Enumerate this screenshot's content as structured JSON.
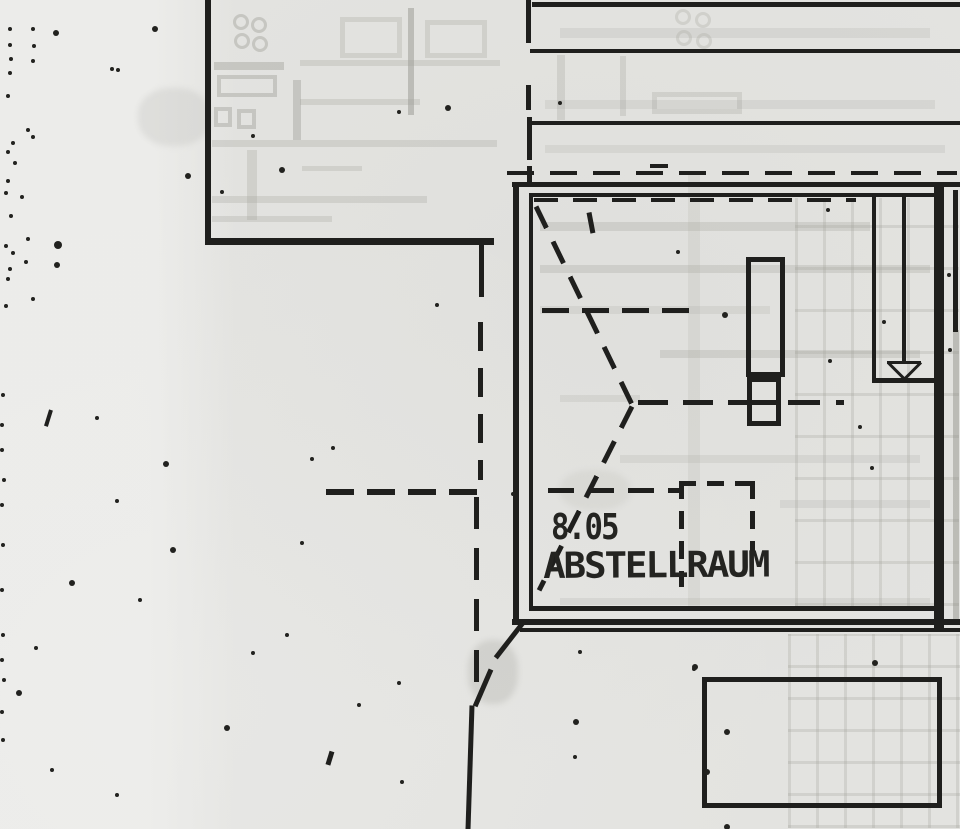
{
  "labels": {
    "room_number": "8.05",
    "room_name": "ABSTELLRAUM"
  },
  "colors": {
    "paper": "#e3e3e0",
    "ink": "#1f1f1d",
    "ghost": "rgba(155,155,148,0.40)",
    "ghost_light": "rgba(165,165,158,0.30)",
    "ghost_faint": "rgba(165,165,158,0.20)",
    "ghost_grid": "rgba(158,158,150,0.26)"
  },
  "elements": [
    {
      "k": "g",
      "n": "ghost-grid-right",
      "x": 795,
      "y": 198,
      "wd": 164,
      "ht": 408,
      "cw": 28,
      "ch": 42,
      "lw": 3,
      "c": "rgba(158,158,150,0.26)"
    },
    {
      "k": "g",
      "n": "ghost-grid-bottom",
      "x": 788,
      "y": 634,
      "wd": 172,
      "ht": 194,
      "cw": 28,
      "ch": 32,
      "lw": 3,
      "c": "rgba(158,158,150,0.26)"
    },
    {
      "k": "v",
      "n": "ghost-crease",
      "x": 688,
      "y": 172,
      "len": 436,
      "w": 12,
      "c": "rgba(170,170,163,0.18)"
    },
    {
      "k": "c",
      "n": "ghost-circle",
      "x": 241,
      "y": 22,
      "r": 8,
      "c": "rgba(155,155,148,0.40)"
    },
    {
      "k": "c",
      "n": "ghost-circle",
      "x": 259,
      "y": 25,
      "r": 8,
      "c": "rgba(155,155,148,0.40)"
    },
    {
      "k": "c",
      "n": "ghost-circle",
      "x": 242,
      "y": 41,
      "r": 8,
      "c": "rgba(155,155,148,0.40)"
    },
    {
      "k": "c",
      "n": "ghost-circle",
      "x": 260,
      "y": 44,
      "r": 8,
      "c": "rgba(155,155,148,0.40)"
    },
    {
      "k": "h",
      "n": "ghost-line",
      "x": 214,
      "y": 62,
      "len": 70,
      "w": 8,
      "c": "rgba(155,155,148,0.40)"
    },
    {
      "k": "r",
      "n": "ghost-rect",
      "x": 217,
      "y": 75,
      "wd": 60,
      "ht": 22,
      "w": 4,
      "c": "rgba(155,155,148,0.40)"
    },
    {
      "k": "r",
      "n": "ghost-rect",
      "x": 214,
      "y": 107,
      "wd": 18,
      "ht": 20,
      "w": 4,
      "c": "rgba(155,155,148,0.40)"
    },
    {
      "k": "r",
      "n": "ghost-rect",
      "x": 237,
      "y": 109,
      "wd": 19,
      "ht": 20,
      "w": 4,
      "c": "rgba(155,155,148,0.40)"
    },
    {
      "k": "v",
      "n": "ghost-line",
      "x": 293,
      "y": 80,
      "len": 60,
      "w": 8,
      "c": "rgba(155,155,148,0.40)"
    },
    {
      "k": "r",
      "n": "ghost-rect",
      "x": 340,
      "y": 17,
      "wd": 62,
      "ht": 41,
      "w": 5,
      "c": "rgba(165,165,158,0.30)"
    },
    {
      "k": "v",
      "n": "ghost-wall-line",
      "x": 408,
      "y": 8,
      "len": 107,
      "w": 6,
      "c": "rgba(150,150,143,0.50)"
    },
    {
      "k": "r",
      "n": "ghost-rect",
      "x": 425,
      "y": 20,
      "wd": 62,
      "ht": 38,
      "w": 5,
      "c": "rgba(165,165,158,0.30)"
    },
    {
      "k": "h",
      "n": "ghost-line",
      "x": 300,
      "y": 60,
      "len": 200,
      "w": 6,
      "c": "rgba(165,165,158,0.30)"
    },
    {
      "k": "h",
      "n": "ghost-line",
      "x": 300,
      "y": 99,
      "len": 120,
      "w": 6,
      "c": "rgba(165,165,158,0.30)"
    },
    {
      "k": "h",
      "n": "ghost-line",
      "x": 212,
      "y": 140,
      "len": 285,
      "w": 7,
      "c": "rgba(165,165,158,0.30)"
    },
    {
      "k": "h",
      "n": "ghost-line",
      "x": 212,
      "y": 196,
      "len": 215,
      "w": 7,
      "c": "rgba(165,165,158,0.30)"
    },
    {
      "k": "h",
      "n": "ghost-line",
      "x": 212,
      "y": 216,
      "len": 120,
      "w": 6,
      "c": "rgba(165,165,158,0.30)"
    },
    {
      "k": "v",
      "n": "ghost-line",
      "x": 247,
      "y": 150,
      "len": 70,
      "w": 10,
      "c": "rgba(165,165,158,0.30)"
    },
    {
      "k": "h",
      "n": "ghost-line",
      "x": 302,
      "y": 166,
      "len": 60,
      "w": 5,
      "c": "rgba(165,165,158,0.30)"
    },
    {
      "k": "c",
      "n": "ghost-circle",
      "x": 683,
      "y": 17,
      "r": 8,
      "c": "rgba(165,165,158,0.30)"
    },
    {
      "k": "c",
      "n": "ghost-circle",
      "x": 703,
      "y": 20,
      "r": 8,
      "c": "rgba(165,165,158,0.30)"
    },
    {
      "k": "c",
      "n": "ghost-circle",
      "x": 684,
      "y": 38,
      "r": 8,
      "c": "rgba(165,165,158,0.30)"
    },
    {
      "k": "c",
      "n": "ghost-circle",
      "x": 704,
      "y": 41,
      "r": 8,
      "c": "rgba(165,165,158,0.30)"
    },
    {
      "k": "h",
      "n": "ghost-band",
      "x": 560,
      "y": 28,
      "len": 370,
      "w": 10,
      "c": "rgba(165,165,158,0.20)"
    },
    {
      "k": "r",
      "n": "ghost-rect",
      "x": 652,
      "y": 92,
      "wd": 90,
      "ht": 22,
      "w": 5,
      "c": "rgba(165,165,158,0.30)"
    },
    {
      "k": "h",
      "n": "ghost-band",
      "x": 545,
      "y": 100,
      "len": 390,
      "w": 9,
      "c": "rgba(165,165,158,0.20)"
    },
    {
      "k": "h",
      "n": "ghost-band",
      "x": 545,
      "y": 145,
      "len": 400,
      "w": 8,
      "c": "rgba(165,165,158,0.20)"
    },
    {
      "k": "v",
      "n": "ghost-line",
      "x": 557,
      "y": 55,
      "len": 65,
      "w": 8,
      "c": "rgba(165,165,158,0.30)"
    },
    {
      "k": "v",
      "n": "ghost-line",
      "x": 620,
      "y": 56,
      "len": 60,
      "w": 6,
      "c": "rgba(165,165,158,0.30)"
    },
    {
      "k": "h",
      "n": "ghost-streak",
      "x": 540,
      "y": 222,
      "len": 330,
      "w": 9,
      "c": "rgba(165,165,158,0.30)"
    },
    {
      "k": "h",
      "n": "ghost-streak",
      "x": 540,
      "y": 265,
      "len": 390,
      "w": 8,
      "c": "rgba(165,165,158,0.30)"
    },
    {
      "k": "h",
      "n": "ghost-streak",
      "x": 540,
      "y": 306,
      "len": 230,
      "w": 8,
      "c": "rgba(165,165,158,0.20)"
    },
    {
      "k": "h",
      "n": "ghost-streak",
      "x": 660,
      "y": 350,
      "len": 260,
      "w": 8,
      "c": "rgba(165,165,158,0.30)"
    },
    {
      "k": "h",
      "n": "ghost-streak",
      "x": 560,
      "y": 395,
      "len": 80,
      "w": 7,
      "c": "rgba(165,165,158,0.20)"
    },
    {
      "k": "h",
      "n": "ghost-streak",
      "x": 620,
      "y": 455,
      "len": 300,
      "w": 8,
      "c": "rgba(165,165,158,0.20)"
    },
    {
      "k": "h",
      "n": "ghost-streak",
      "x": 780,
      "y": 500,
      "len": 150,
      "w": 8,
      "c": "rgba(165,165,158,0.20)"
    },
    {
      "k": "h",
      "n": "ghost-streak",
      "x": 560,
      "y": 598,
      "len": 370,
      "w": 7,
      "c": "rgba(165,165,158,0.20)"
    },
    {
      "k": "v",
      "n": "edge-wall-ghost",
      "x": 953,
      "y": 330,
      "len": 295,
      "w": 6,
      "c": "rgba(140,140,133,0.45)"
    },
    {
      "k": "b",
      "n": "smudge",
      "x": 468,
      "y": 640,
      "wd": 50,
      "ht": 64,
      "c": "rgba(175,175,168,0.35)"
    },
    {
      "k": "b",
      "n": "smudge",
      "x": 138,
      "y": 88,
      "wd": 72,
      "ht": 58,
      "c": "rgba(190,190,184,0.30)"
    },
    {
      "k": "b",
      "n": "smudge",
      "x": 560,
      "y": 470,
      "wd": 70,
      "ht": 40,
      "c": "rgba(190,190,184,0.25)"
    },
    {
      "k": "v",
      "n": "upper-left-wall-vertical",
      "x": 205,
      "y": 0,
      "len": 244,
      "w": 6
    },
    {
      "k": "h",
      "n": "upper-left-wall-horizontal",
      "x": 205,
      "y": 238,
      "len": 289,
      "w": 7
    },
    {
      "k": "v",
      "n": "wall-stub",
      "x": 479,
      "y": 245,
      "len": 52,
      "w": 5
    },
    {
      "k": "h",
      "n": "top-wall-line-1",
      "x": 532,
      "y": 2,
      "len": 428,
      "w": 5
    },
    {
      "k": "h",
      "n": "top-wall-line-2",
      "x": 530,
      "y": 49,
      "len": 430,
      "w": 4
    },
    {
      "k": "h",
      "n": "top-wall-line-3",
      "x": 530,
      "y": 121,
      "len": 430,
      "w": 4
    },
    {
      "k": "v",
      "n": "boundary-dash",
      "x": 526,
      "y": 0,
      "len": 43,
      "w": 5
    },
    {
      "k": "v",
      "n": "boundary-dash",
      "x": 526,
      "y": 85,
      "len": 25,
      "w": 5
    },
    {
      "k": "v",
      "n": "boundary-dash",
      "x": 527,
      "y": 117,
      "len": 43,
      "w": 5
    },
    {
      "k": "v",
      "n": "boundary-dash",
      "x": 527,
      "y": 166,
      "len": 16,
      "w": 5
    },
    {
      "k": "h",
      "n": "eaves-dashed-line",
      "x": 507,
      "y": 171,
      "len": 450,
      "w": 4,
      "dash": 27,
      "gap": 16
    },
    {
      "k": "h",
      "n": "room-wall-top-outer",
      "x": 512,
      "y": 182,
      "len": 448,
      "w": 5
    },
    {
      "k": "h",
      "n": "room-wall-top-inner",
      "x": 529,
      "y": 193,
      "len": 406,
      "w": 4
    },
    {
      "k": "v",
      "n": "room-wall-left-outer",
      "x": 513,
      "y": 182,
      "len": 440,
      "w": 6
    },
    {
      "k": "v",
      "n": "room-wall-left-inner",
      "x": 529,
      "y": 193,
      "len": 415,
      "w": 4
    },
    {
      "k": "v",
      "n": "room-wall-right",
      "x": 934,
      "y": 182,
      "len": 450,
      "w": 10
    },
    {
      "k": "h",
      "n": "room-wall-bottom-inner",
      "x": 529,
      "y": 606,
      "len": 406,
      "w": 5
    },
    {
      "k": "h",
      "n": "room-wall-bottom-outer",
      "x": 512,
      "y": 619,
      "len": 448,
      "w": 6
    },
    {
      "k": "h",
      "n": "room-wall-bottom-outer2",
      "x": 520,
      "y": 628,
      "len": 440,
      "w": 4
    },
    {
      "k": "s",
      "n": "corner-diagonal",
      "x1": 524,
      "y1": 621,
      "x2": 496,
      "y2": 657,
      "w": 5
    },
    {
      "k": "v",
      "n": "edge-wall-line",
      "x": 953,
      "y": 190,
      "len": 142,
      "w": 5
    },
    {
      "k": "h",
      "n": "inner-top-dashed",
      "x": 534,
      "y": 198,
      "len": 322,
      "w": 4,
      "dash": 24,
      "gap": 15
    },
    {
      "k": "v",
      "n": "stair-side-line",
      "x": 872,
      "y": 193,
      "len": 188,
      "w": 4
    },
    {
      "k": "v",
      "n": "stair-center-line",
      "x": 902,
      "y": 193,
      "len": 170,
      "w": 4
    },
    {
      "k": "h",
      "n": "stair-bottom-line",
      "x": 872,
      "y": 378,
      "len": 64,
      "w": 5
    },
    {
      "k": "s",
      "n": "stair-arrow-top",
      "x1": 887,
      "y1": 362,
      "x2": 921,
      "y2": 362,
      "w": 3
    },
    {
      "k": "s",
      "n": "stair-arrow-left",
      "x1": 888,
      "y1": 362,
      "x2": 904,
      "y2": 378,
      "w": 3
    },
    {
      "k": "s",
      "n": "stair-arrow-right",
      "x1": 921,
      "y1": 362,
      "x2": 905,
      "y2": 378,
      "w": 3
    },
    {
      "k": "r",
      "n": "chimney-rect",
      "x": 746,
      "y": 257,
      "wd": 39,
      "ht": 120,
      "w": 5
    },
    {
      "k": "r",
      "n": "chimney-base-rect",
      "x": 747,
      "y": 377,
      "wd": 34,
      "ht": 49,
      "w": 5
    },
    {
      "k": "h",
      "n": "chimney-base-divider",
      "x": 747,
      "y": 400,
      "len": 34,
      "w": 5
    },
    {
      "k": "s",
      "n": "ceiling-dash-down",
      "x1": 536,
      "y1": 206,
      "x2": 632,
      "y2": 404,
      "w": 5,
      "dash": 24,
      "gap": 15
    },
    {
      "k": "s",
      "n": "ceiling-dash-up",
      "x1": 632,
      "y1": 406,
      "x2": 539,
      "y2": 590,
      "w": 5,
      "dash": 24,
      "gap": 15
    },
    {
      "k": "s",
      "n": "small-dash-tick",
      "x1": 589,
      "y1": 212,
      "x2": 593,
      "y2": 233,
      "w": 5
    },
    {
      "k": "h",
      "n": "center-dashed-line",
      "x": 638,
      "y": 400,
      "len": 110,
      "w": 5,
      "dash": 30,
      "gap": 15
    },
    {
      "k": "h",
      "n": "center-dashed-line",
      "x": 788,
      "y": 400,
      "len": 56,
      "w": 5,
      "dash": 32,
      "gap": 16
    },
    {
      "k": "h",
      "n": "dashed-line-mid",
      "x": 542,
      "y": 308,
      "len": 147,
      "w": 5,
      "dash": 27,
      "gap": 13
    },
    {
      "k": "h",
      "n": "dashed-line-outside",
      "x": 326,
      "y": 489,
      "len": 163,
      "w": 6,
      "dash": 28,
      "gap": 13
    },
    {
      "k": "h",
      "n": "dashed-line-inside",
      "x": 548,
      "y": 488,
      "len": 136,
      "w": 5,
      "dash": 26,
      "gap": 14
    },
    {
      "k": "v",
      "n": "section-dashed-vertical",
      "x": 478,
      "y": 322,
      "len": 158,
      "w": 5,
      "dash": 29,
      "gap": 17
    },
    {
      "k": "v",
      "n": "section-dashed-vertical",
      "x": 474,
      "y": 497,
      "len": 200,
      "w": 5,
      "dash": 32,
      "gap": 19
    },
    {
      "k": "s",
      "n": "section-diagonal",
      "x1": 491,
      "y1": 669,
      "x2": 475,
      "y2": 706,
      "w": 5
    },
    {
      "k": "s",
      "n": "section-line-solid",
      "x1": 472,
      "y1": 705,
      "x2": 468,
      "y2": 829,
      "w": 5
    },
    {
      "k": "h",
      "n": "dashed-square-top",
      "x": 679,
      "y": 481,
      "len": 76,
      "w": 5,
      "dash": 17,
      "gap": 11
    },
    {
      "k": "v",
      "n": "dashed-square-left",
      "x": 679,
      "y": 481,
      "len": 106,
      "w": 5,
      "dash": 18,
      "gap": 12
    },
    {
      "k": "v",
      "n": "dashed-square-right",
      "x": 750,
      "y": 481,
      "len": 70,
      "w": 5,
      "dash": 18,
      "gap": 12
    },
    {
      "k": "r",
      "n": "lower-rect",
      "x": 702,
      "y": 677,
      "wd": 240,
      "ht": 131,
      "w": 5
    },
    {
      "k": "s",
      "n": "tick-mark",
      "x1": 51,
      "y1": 410,
      "x2": 46,
      "y2": 426,
      "w": 4
    },
    {
      "k": "s",
      "n": "tick-mark",
      "x1": 332,
      "y1": 751,
      "x2": 328,
      "y2": 764,
      "w": 5
    },
    {
      "k": "h",
      "n": "stray-dash",
      "x": 650,
      "y": 164,
      "len": 18,
      "w": 4
    }
  ],
  "dots": [
    [
      10,
      29,
      2
    ],
    [
      33,
      29,
      2
    ],
    [
      56,
      33,
      3
    ],
    [
      155,
      29,
      3
    ],
    [
      118,
      70,
      2
    ],
    [
      10,
      45,
      2
    ],
    [
      34,
      46,
      2
    ],
    [
      11,
      59,
      2
    ],
    [
      33,
      61,
      2
    ],
    [
      10,
      73,
      2
    ],
    [
      8,
      96,
      2
    ],
    [
      28,
      130,
      2
    ],
    [
      13,
      143,
      2
    ],
    [
      33,
      137,
      2
    ],
    [
      8,
      152,
      2
    ],
    [
      15,
      163,
      2
    ],
    [
      8,
      181,
      2
    ],
    [
      6,
      193,
      2
    ],
    [
      22,
      197,
      2
    ],
    [
      11,
      216,
      2
    ],
    [
      28,
      239,
      2
    ],
    [
      6,
      246,
      2
    ],
    [
      13,
      253,
      2
    ],
    [
      26,
      262,
      2
    ],
    [
      10,
      269,
      2
    ],
    [
      8,
      279,
      2
    ],
    [
      33,
      299,
      2
    ],
    [
      6,
      306,
      2
    ],
    [
      58,
      245,
      4
    ],
    [
      57,
      265,
      3
    ],
    [
      112,
      69,
      2
    ],
    [
      282,
      170,
      3
    ],
    [
      188,
      176,
      3
    ],
    [
      222,
      192,
      2
    ],
    [
      448,
      108,
      3
    ],
    [
      399,
      112,
      2
    ],
    [
      253,
      136,
      2
    ],
    [
      437,
      305,
      2
    ],
    [
      678,
      252,
      2
    ],
    [
      725,
      315,
      3
    ],
    [
      828,
      210,
      2
    ],
    [
      830,
      361,
      2
    ],
    [
      884,
      322,
      2
    ],
    [
      860,
      427,
      2
    ],
    [
      872,
      468,
      2
    ],
    [
      949,
      275,
      2
    ],
    [
      950,
      350,
      2
    ],
    [
      513,
      494,
      2
    ],
    [
      97,
      418,
      2
    ],
    [
      166,
      464,
      3
    ],
    [
      312,
      459,
      2
    ],
    [
      333,
      448,
      2
    ],
    [
      117,
      501,
      2
    ],
    [
      302,
      543,
      2
    ],
    [
      173,
      550,
      3
    ],
    [
      72,
      583,
      3
    ],
    [
      140,
      600,
      2
    ],
    [
      287,
      635,
      2
    ],
    [
      36,
      648,
      2
    ],
    [
      253,
      653,
      2
    ],
    [
      19,
      693,
      3
    ],
    [
      359,
      705,
      2
    ],
    [
      227,
      728,
      3
    ],
    [
      399,
      683,
      2
    ],
    [
      402,
      782,
      2
    ],
    [
      117,
      795,
      2
    ],
    [
      52,
      770,
      2
    ],
    [
      580,
      652,
      2
    ],
    [
      576,
      722,
      3
    ],
    [
      575,
      757,
      2
    ],
    [
      694,
      669,
      2
    ],
    [
      707,
      772,
      3
    ],
    [
      695,
      667,
      3
    ],
    [
      875,
      663,
      3
    ],
    [
      727,
      732,
      3
    ],
    [
      727,
      827,
      3
    ],
    [
      560,
      103,
      2
    ],
    [
      3,
      395,
      2
    ],
    [
      2,
      425,
      2
    ],
    [
      2,
      450,
      2
    ],
    [
      4,
      480,
      2
    ],
    [
      2,
      505,
      2
    ],
    [
      3,
      545,
      2
    ],
    [
      2,
      590,
      2
    ],
    [
      3,
      635,
      2
    ],
    [
      2,
      660,
      2
    ],
    [
      4,
      680,
      2
    ],
    [
      2,
      712,
      2
    ],
    [
      3,
      740,
      2
    ]
  ]
}
